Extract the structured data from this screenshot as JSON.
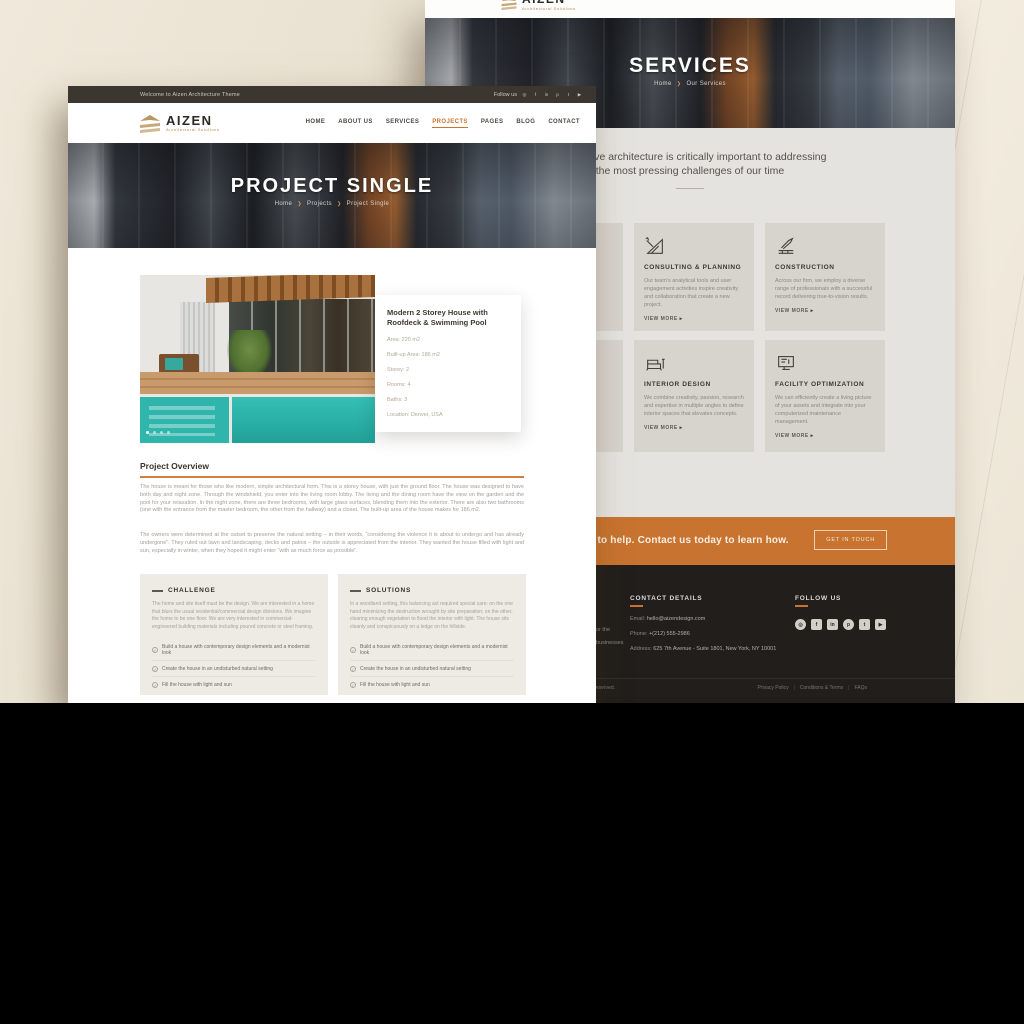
{
  "colors": {
    "accent_orange": "#c8732f",
    "dark_bar": "#3b362f",
    "footer_dark": "#221e1b",
    "beige_background": "#e9e1d1",
    "pool_teal": "#2fb5ab",
    "gold_logo": "#b08b4f"
  },
  "icons": {
    "chevron": "❯",
    "arrow": "▸",
    "check": "✓"
  },
  "social_icons": [
    {
      "name": "instagram",
      "glyph": "◎"
    },
    {
      "name": "facebook",
      "glyph": "f"
    },
    {
      "name": "linkedin",
      "glyph": "in"
    },
    {
      "name": "pinterest",
      "glyph": "p"
    },
    {
      "name": "twitter",
      "glyph": "t"
    },
    {
      "name": "youtube",
      "glyph": "▶"
    }
  ],
  "back_page": {
    "logo_name": "AIZEN",
    "logo_tagline": "Architectural Solutions",
    "hero_title": "SERVICES",
    "breadcrumb": {
      "home": "Home",
      "current": "Our Services"
    },
    "intro_line1": "We believe architecture is critically important to addressing",
    "intro_line2": "the most pressing challenges of our time",
    "view_more": "VIEW MORE",
    "services": [
      {
        "title": "CONSULTING & PLANNING",
        "desc": "Our team's analytical tools and user engagement activities inspire creativity and collaboration that create a new project."
      },
      {
        "title": "CONSTRUCTION",
        "desc": "Across our firm, we employ a diverse range of professionals with a successful record delivering true-to-vision results."
      },
      {
        "title": "INTERIOR DESIGN",
        "desc": "We combine creativity, passion, research and expertise in multiple angles to define interior spaces that elevates concepts."
      },
      {
        "title": "FACILITY OPTIMIZATION",
        "desc": "We can efficiently create a living picture of your assets and integrate into your computerized maintenance management."
      }
    ],
    "cta_text": "We are ready to help. Contact us today to learn how.",
    "cta_button": "GET IN TOUCH",
    "footer": {
      "contact_heading": "CONTACT DETAILS",
      "email_label": "Email:",
      "email_value": "hello@aizendesign.com",
      "phone_label": "Phone:",
      "phone_value": "+(212) 555-2986",
      "address_label": "Address:",
      "address_value": "625 7th Avenue - Suite 1801, New York, NY 10001",
      "follow_heading": "FOLLOW US",
      "about_fragment_line1": "or the",
      "about_fragment_line2": "businesses",
      "copyright": "All rights reserved.",
      "link_privacy": "Privacy Policy",
      "link_terms": "Conditions & Terms",
      "link_faq": "FAQs"
    }
  },
  "front_page": {
    "topbar_welcome": "Welcome to Aizen Architecture Theme",
    "topbar_follow": "Follow us",
    "logo_name": "AIZEN",
    "logo_tagline": "Architectural Solutions",
    "nav": [
      "HOME",
      "ABOUT US",
      "SERVICES",
      "PROJECTS",
      "PAGES",
      "BLOG",
      "CONTACT"
    ],
    "hero_title": "PROJECT SINGLE",
    "breadcrumb": {
      "home": "Home",
      "section": "Projects",
      "current": "Project Single"
    },
    "info_card": {
      "title": "Modern 2 Storey House with Roofdeck & Swimming Pool",
      "details": [
        "Area: 220 m2",
        "Built-up Area: 186 m2",
        "Storey: 2",
        "Rooms: 4",
        "Baths: 3",
        "Location: Denver, USA"
      ]
    },
    "overview_heading": "Project Overview",
    "overview_p1": "The house is meant for those who like modern, simple architectural form. This is a storey house, with just the ground floor. The house was designed to have both day and night zone. Through the windshield, you enter into the living room lobby. The living and the dining room have the view on the garden and the pool for your relaxation. In the night zone, there are three bedrooms, with large glass surfaces, blending them into the exterior. There are also two bathrooms (one with the entrance from the master bedroom, the other from the hallway) and a closet. The built-up area of the house makes for 186 m2.",
    "overview_p2": "The owners were determined at the outset to preserve the natural setting – in their words, “considering the violence it is about to undergo and has already undergone”. They ruled out lawn and landscaping, decks and patios – the outside is appreciated from the interior. They wanted the house filled with light and sun, especially in winter, when they hoped it might enter “with as much force as possible”.",
    "challenge": {
      "title": "CHALLENGE",
      "desc": "The home and site itself must be the design. We are interested in a home that blurs the usual residential/commercial design divisions. We imagine the home to be one floor. We are very interested in commercial-engineered building materials including poured concrete or steel framing.",
      "items": [
        "Build a house with contemporary design elements and a modernist look",
        "Create the house in an undisturbed natural setting",
        "Fill the house with light and sun"
      ]
    },
    "solutions": {
      "title": "SOLUTIONS",
      "desc": "In a woodland setting, this balancing act required special care: on the one hand minimizing the destruction wrought by site preparation; on the other, clearing enough vegetation to flood the interior with light. The house sits cleanly and conspicuously on a ledge on the hillside.",
      "items": [
        "Build a house with contemporary design elements and a modernist look",
        "Create the house in an undisturbed natural setting",
        "Fill the house with light and sun"
      ]
    }
  }
}
